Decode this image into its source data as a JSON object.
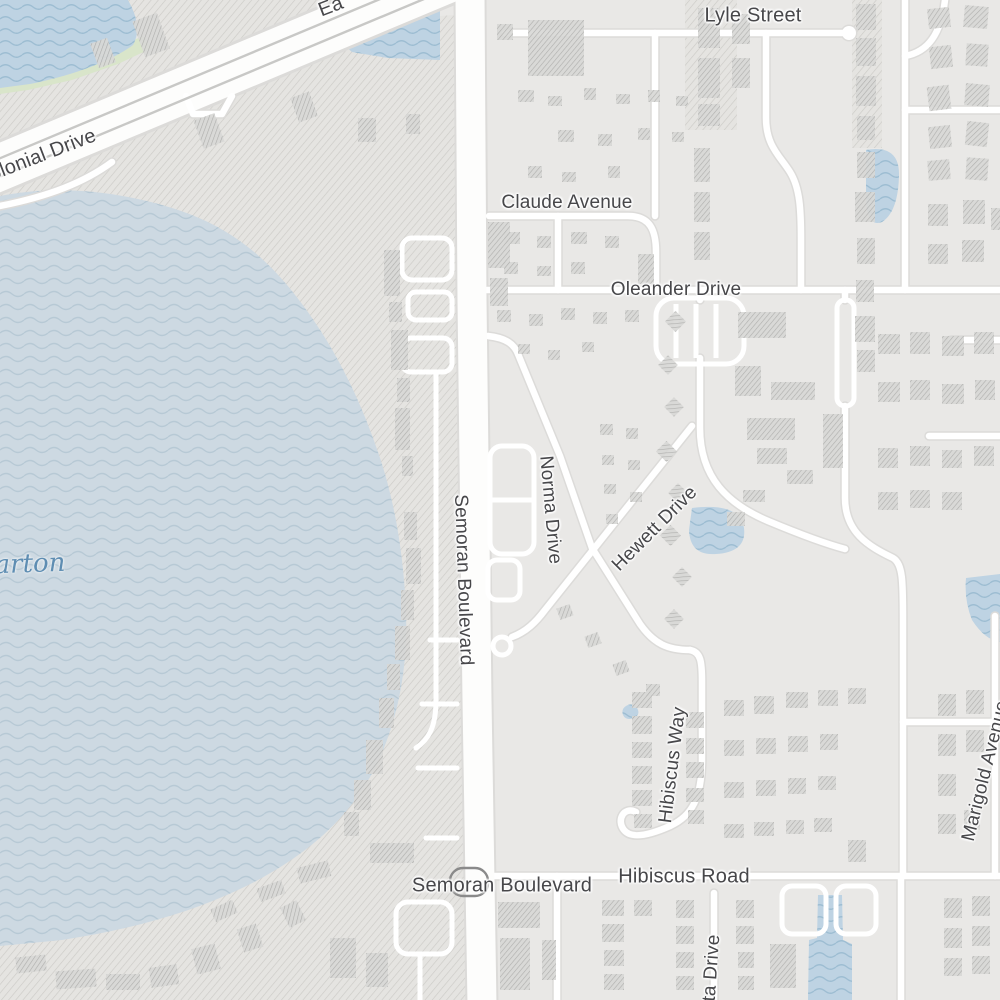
{
  "map": {
    "description": "street map view, residential area east of a large lake",
    "labels": [
      {
        "id": "lyle-street",
        "text": "Lyle Street",
        "kind": "street",
        "x": 753,
        "y": 16,
        "rot": 0,
        "size": 20
      },
      {
        "id": "east-colonial-drive-partial",
        "text": "Ea",
        "kind": "street",
        "x": 331,
        "y": 7,
        "rot": -21,
        "size": 20
      },
      {
        "id": "colonial-drive",
        "text": "Colonial Drive",
        "kind": "street",
        "x": 36,
        "y": 158,
        "rot": -21,
        "size": 20
      },
      {
        "id": "claude-avenue",
        "text": "Claude Avenue",
        "kind": "street",
        "x": 567,
        "y": 203,
        "rot": 0,
        "size": 19
      },
      {
        "id": "oleander-drive",
        "text": "Oleander Drive",
        "kind": "street",
        "x": 676,
        "y": 290,
        "rot": 0,
        "size": 19
      },
      {
        "id": "norma-drive",
        "text": "Norma Drive",
        "kind": "street",
        "x": 550,
        "y": 510,
        "rot": 85,
        "size": 19
      },
      {
        "id": "hewett-drive",
        "text": "Hewett Drive",
        "kind": "street",
        "x": 655,
        "y": 529,
        "rot": -45,
        "size": 19
      },
      {
        "id": "semoran-boulevard-vertical",
        "text": "Semoran Boulevard",
        "kind": "street",
        "x": 463,
        "y": 580,
        "rot": 88,
        "size": 19
      },
      {
        "id": "hibiscus-way",
        "text": "Hibiscus Way",
        "kind": "street",
        "x": 673,
        "y": 765,
        "rot": -83,
        "size": 19
      },
      {
        "id": "marigold-avenue",
        "text": "Marigold Avenue",
        "kind": "street",
        "x": 986,
        "y": 771,
        "rot": -76,
        "size": 19
      },
      {
        "id": "hibiscus-road",
        "text": "Hibiscus Road",
        "kind": "street",
        "x": 684,
        "y": 877,
        "rot": 0,
        "size": 20
      },
      {
        "id": "semoran-boulevard-horizontal",
        "text": "Semoran Boulevard",
        "kind": "street",
        "x": 502,
        "y": 886,
        "rot": 0,
        "size": 20
      },
      {
        "id": "ta-drive-partial",
        "text": "ta Drive",
        "kind": "street",
        "x": 712,
        "y": 968,
        "rot": -86,
        "size": 19
      },
      {
        "id": "lake-name-partial",
        "text": "arton",
        "kind": "water",
        "x": 30,
        "y": 564,
        "rot": -2,
        "size": 26
      }
    ],
    "route_shield": {
      "shape": "rounded-rectangle-outline",
      "x": 469,
      "y": 882,
      "width": 38,
      "height": 28,
      "label": ""
    },
    "colors": {
      "land": "#e9e8e6",
      "area_fill": "#e5e4e1",
      "area_hatch": "#c7c6c2",
      "lake": "#cdd9e2",
      "lake_wave": "#b7c9d5",
      "pond": "#bed3e3",
      "pond_wave": "#9dbdd2",
      "park": "#d9e5ca",
      "road_fill": "#ffffff",
      "major_road_fill": "#fdfdfc",
      "road_casing": "#dcdbd9",
      "median_line": "#c8c8c6",
      "building": "#d8d8d6",
      "building_hatch": "#a9a9a7",
      "street_label": "#47474a",
      "water_label": "#5e8db2",
      "shield_outline": "#8a8a8a"
    }
  }
}
